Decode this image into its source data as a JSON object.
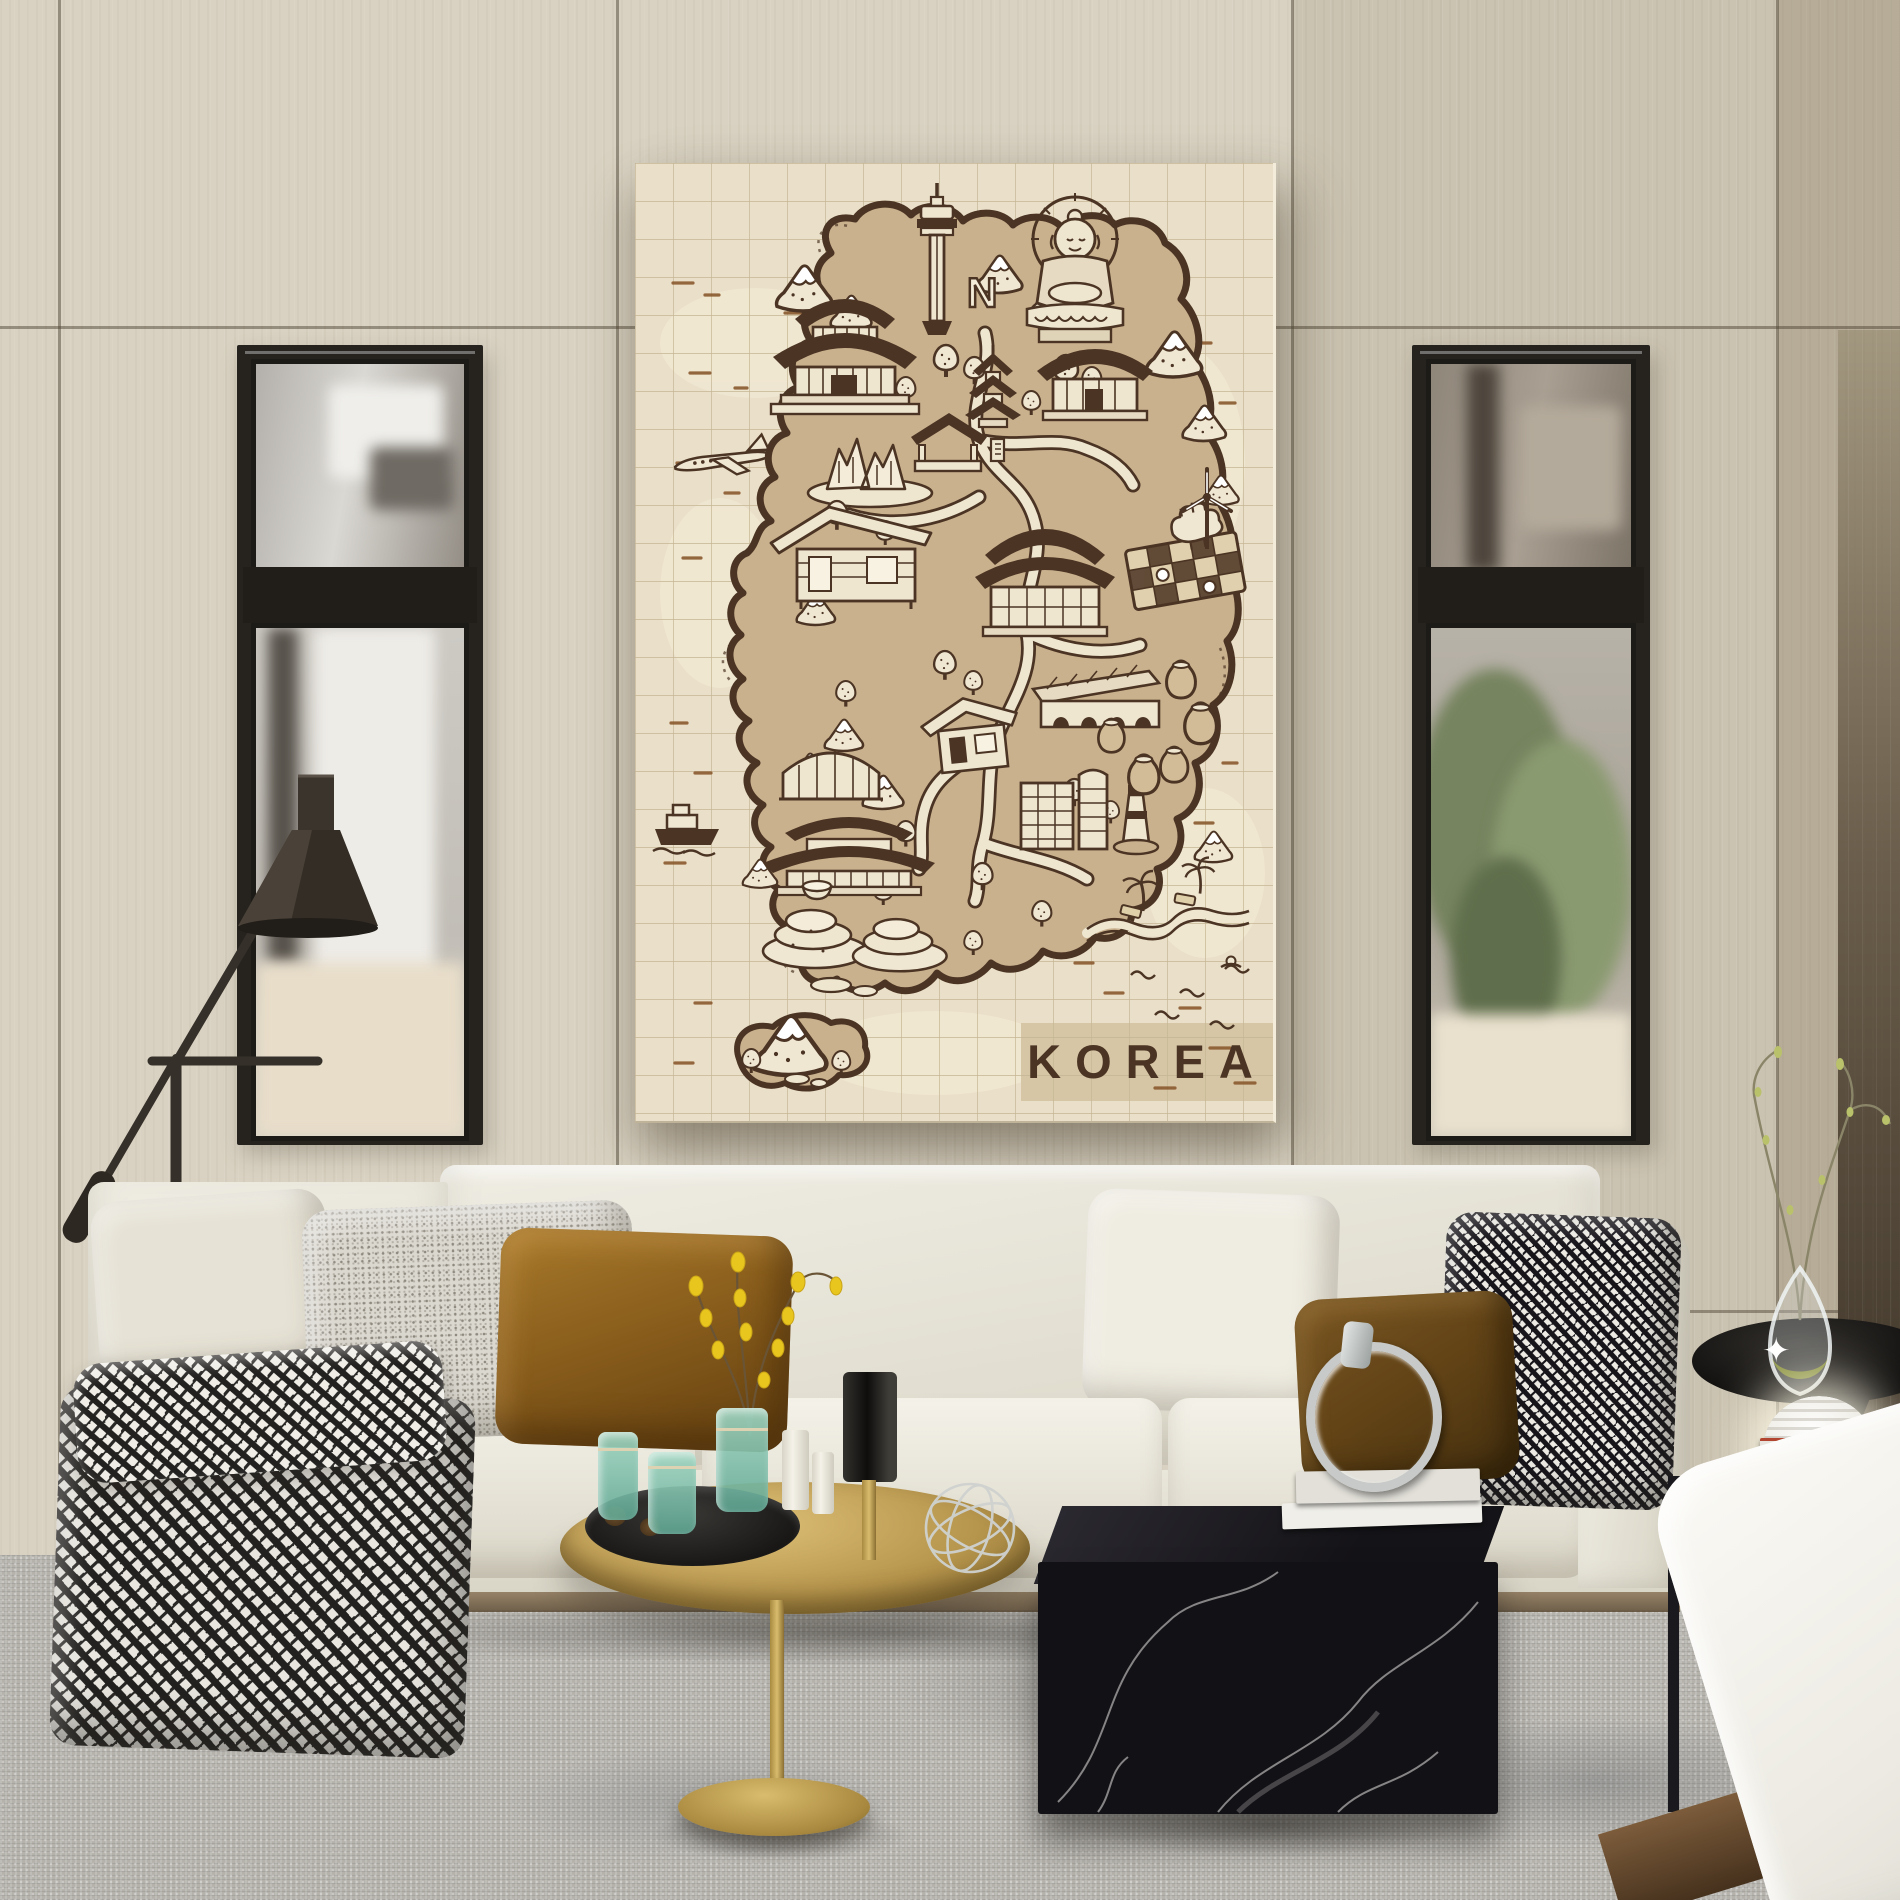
{
  "scene": {
    "title": "Living room with illustrated Korea travel-map canvas",
    "canvas_print": {
      "title": "KOREA",
      "tower_label": "N",
      "style": "vintage sepia hand-drawn pictorial map on grid paper",
      "colors": {
        "paper": "#eadfc8",
        "land": "#c9b18e",
        "ink": "#4b3423",
        "grid": "#c4b694",
        "title_band": "#d6c6a5",
        "dash_accent": "#8a5a2e",
        "light_fill": "#f0e7d2"
      },
      "landmarks": [
        "n-seoul-tower-icon",
        "great-buddha-icon",
        "palace-icon",
        "temple-hanok-icon",
        "pagoda-icon",
        "street-food-stall-icon",
        "rocky-crags-icon",
        "snow-mountain-icon",
        "round-tree-icon",
        "airplane-icon",
        "ferry-boat-icon",
        "go-board-ginseng-icon",
        "wind-turbine-icon",
        "plank-house-icon",
        "kiln-arches-icon",
        "onggi-jars-icon",
        "greenhouse-icon",
        "modern-buildings-icon",
        "lighthouse-icon",
        "terraced-fields-icon",
        "beach-waves-icon",
        "jeju-island-icon"
      ]
    },
    "room": {
      "wall": {
        "panel_light": "#d9d2c2",
        "panel_mid": "#cbc3b1",
        "panel_dark": "#b6ac97",
        "seam": "#50462f"
      },
      "windows": {
        "frame": "#26231f",
        "view_left": "blurred white brick building",
        "view_right": "green foliage and brick"
      },
      "furniture": {
        "sofa": "#ebe8de",
        "rug": "#b5b2ac",
        "throw": "black-white houndstooth",
        "pillows": [
          "beige",
          "grey boucle",
          "caramel velvet",
          "white",
          "houndstooth",
          "brown velvet"
        ],
        "coffee_table_gold": "#b6954c",
        "coffee_table_marble": "#121116",
        "floor_lamp": "dark bronze cone",
        "side_table": "black pedestal bowl",
        "accents": {
          "teal_glass": "#8fc9b8",
          "flower_yellow": "#e8c61e",
          "sphere_lamp": "#ffffff",
          "books": "#efeee8"
        }
      }
    }
  }
}
